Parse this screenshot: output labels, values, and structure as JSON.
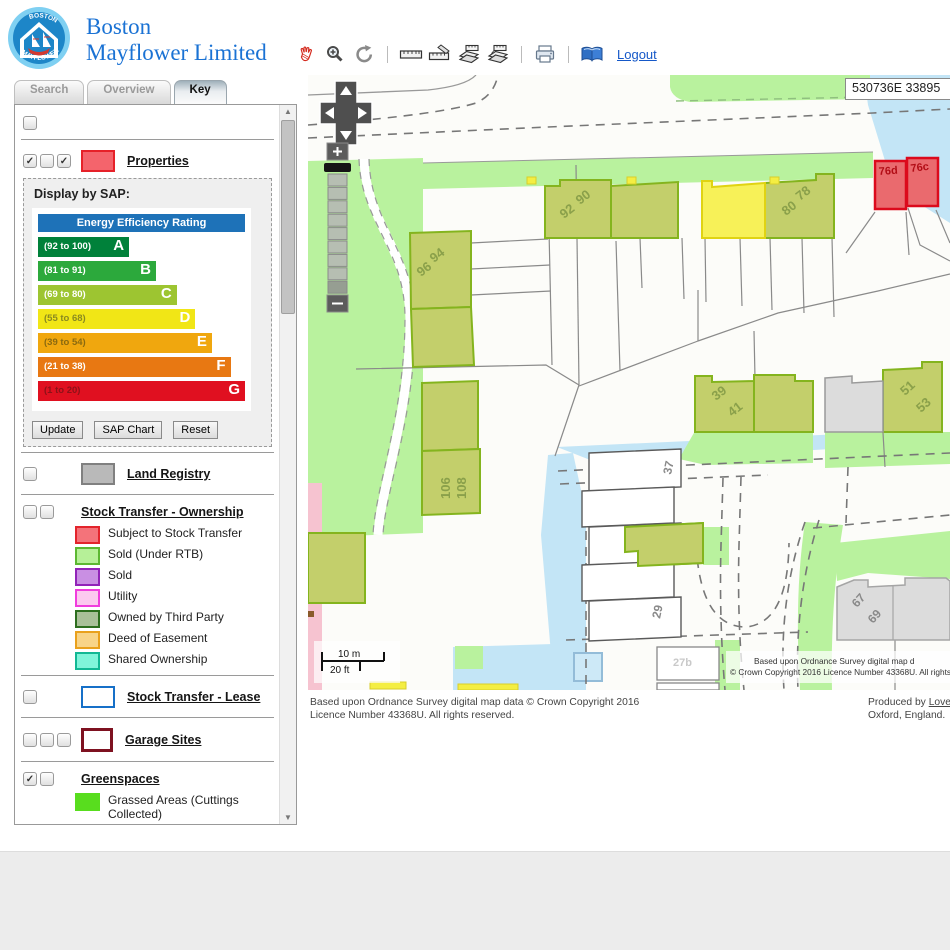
{
  "header": {
    "brand_line1": "Boston",
    "brand_line2": "Mayflower Limited",
    "logo_top": "BOSTON",
    "logo_bottom": "MAYFLOWER",
    "logout_label": "Logout",
    "brand_color": "#1a72d4",
    "toolbar_icons": [
      "pan-hand",
      "zoom-in",
      "refresh",
      "measure-ruler",
      "measure-area",
      "map-layers-1",
      "map-layers-2",
      "print",
      "book",
      "logout"
    ]
  },
  "tabs": [
    {
      "label": "Search",
      "active": false
    },
    {
      "label": "Overview",
      "active": false
    },
    {
      "label": "Key",
      "active": true
    }
  ],
  "panel": {
    "top_checkboxes": [
      false
    ],
    "properties": {
      "label": "Properties",
      "checkboxes": [
        true,
        false,
        true
      ],
      "swatch": {
        "fill": "#f4646c",
        "border": "#e62129"
      }
    },
    "sap": {
      "title": "Display by SAP:",
      "chart_header": "Energy Efficiency Rating",
      "header_color": "#1e72b8",
      "bands": [
        {
          "range": "(92 to 100)",
          "letter": "A",
          "color": "#00813a",
          "width": 44,
          "text_color": "#ffffff"
        },
        {
          "range": "(81 to 91)",
          "letter": "B",
          "color": "#2ca93c",
          "width": 57,
          "text_color": "#ffffff"
        },
        {
          "range": "(69 to 80)",
          "letter": "C",
          "color": "#9dc531",
          "width": 67,
          "text_color": "#ffffff"
        },
        {
          "range": "(55 to 68)",
          "letter": "D",
          "color": "#f1e616",
          "width": 76,
          "text_color": "#8a8a20"
        },
        {
          "range": "(39 to 54)",
          "letter": "E",
          "color": "#f0a70e",
          "width": 84,
          "text_color": "#8a6a10"
        },
        {
          "range": "(21 to 38)",
          "letter": "F",
          "color": "#e87812",
          "width": 93,
          "text_color": "#ffffff"
        },
        {
          "range": "(1 to 20)",
          "letter": "G",
          "color": "#e01020",
          "width": 100,
          "text_color": "#8c1218"
        }
      ],
      "buttons": [
        "Update",
        "SAP Chart",
        "Reset"
      ]
    },
    "land_registry": {
      "label": "Land Registry",
      "checkboxes": [
        false
      ],
      "swatch": {
        "fill": "#b9b9b9",
        "border": "#808080"
      }
    },
    "stock_ownership": {
      "label": "Stock Transfer - Ownership",
      "checkboxes": [
        false,
        false
      ],
      "items": [
        {
          "label": "Subject to Stock Transfer",
          "fill": "#f4737a",
          "border": "#e3242c"
        },
        {
          "label": "Sold (Under RTB)",
          "fill": "#b6f098",
          "border": "#5cb832"
        },
        {
          "label": "Sold",
          "fill": "#c98fe3",
          "border": "#9123b8"
        },
        {
          "label": "Utility",
          "fill": "#fcc9ef",
          "border": "#f03ddd"
        },
        {
          "label": "Owned by Third Party",
          "fill": "#a9c098",
          "border": "#2d6e1e"
        },
        {
          "label": "Deed of Easement",
          "fill": "#f8d488",
          "border": "#e9a11d"
        },
        {
          "label": "Shared Ownership",
          "fill": "#80f5da",
          "border": "#12b894"
        }
      ]
    },
    "stock_lease": {
      "label": "Stock Transfer - Lease",
      "checkboxes": [
        false
      ],
      "swatch": {
        "fill": "#ffffff",
        "border": "#1670c8"
      }
    },
    "garage_sites": {
      "label": "Garage Sites",
      "checkboxes": [
        false,
        false,
        false
      ],
      "swatch": {
        "fill": "#ffffff",
        "border": "#7e1120"
      }
    },
    "greenspaces": {
      "label": "Greenspaces",
      "checkboxes": [
        true,
        false
      ],
      "items": [
        {
          "label": "Grassed Areas (Cuttings Collected)",
          "fill": "#58dd1e",
          "border": ""
        },
        {
          "label": "Grassed Areas (Cuttings",
          "fill": "#a4ea7e",
          "border": ""
        }
      ]
    }
  },
  "map": {
    "coordinates": "530736E 33895",
    "scale_m": "10 m",
    "scale_ft": "20 ft",
    "copyright_line1": "Based upon Ordnance Survey digital map d",
    "copyright_line2": "© Crown Copyright 2016 Licence Number 43368U. All rights reserv",
    "building_labels": {
      "b90": "90",
      "b92": "92",
      "b94": "94",
      "b96": "96",
      "b106": "106",
      "b108": "108",
      "b78": "78",
      "b80": "80",
      "b76d": "76d",
      "b76c": "76c",
      "b39": "39",
      "b41": "41",
      "b51": "51",
      "b53": "53",
      "b37": "37",
      "b29": "29",
      "b27b": "27b",
      "b67": "67",
      "b69": "69"
    },
    "colors": {
      "greenspace": "#b9f29e",
      "water": "#c3e5f6",
      "olive_fill": "#c3cf6b",
      "olive_border": "#84b41e",
      "red_fill": "#ea6a6e",
      "red_border": "#dc0a1c",
      "gray_fill": "#dcdcdc",
      "yellow_fill": "#f7f158",
      "pink": "#f6c3d0"
    }
  },
  "attribution": {
    "os_text": "Based upon Ordnance Survey digital map data © Crown Copyright 2016 Licence Number 43368U. All rights reserved.",
    "produced_prefix": "Produced by ",
    "produced_link": "Lovell Johns Lim",
    "produced_line2": "Oxford, England."
  }
}
